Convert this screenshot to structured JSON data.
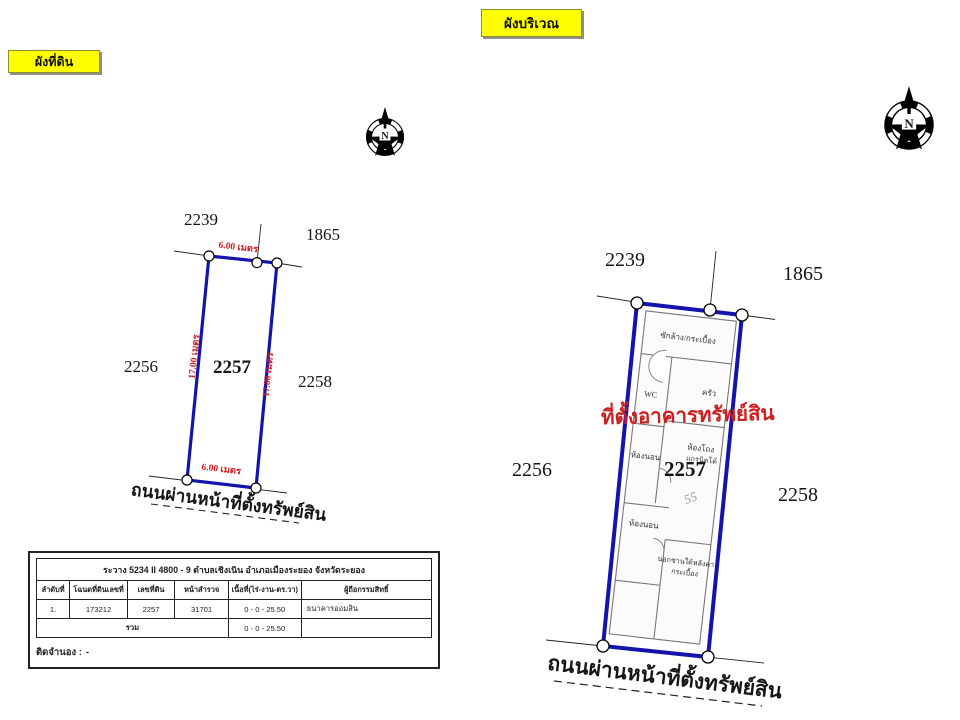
{
  "colors": {
    "boundary_blue": "#1414ad",
    "dimension_red": "#cc1f1f",
    "tag_yellow": "#ffff00",
    "wall_gray": "#777777"
  },
  "tags": {
    "land_plan": "ผังที่ดิน",
    "site_plan": "ผังบริเวณ"
  },
  "compass": {
    "letter": "N"
  },
  "land_plan": {
    "parcel_number": "2257",
    "neighbors": {
      "top_left": "2239",
      "top_right": "1865",
      "left": "2256",
      "right": "2258"
    },
    "dimensions": {
      "top": "6.00 เมตร",
      "bottom": "6.00 เมตร",
      "left": "17.00 เมตร",
      "right": "17.00 เมตร"
    },
    "road_label": "ถนนผ่านหน้าที่ตั้งทรัพย์สิน"
  },
  "site_plan": {
    "parcel_number": "2257",
    "neighbors": {
      "top_left": "2239",
      "top_right": "1865",
      "left": "2256",
      "right": "2258"
    },
    "building_label": "ที่ตั้งอาคารทรัพย์สิน",
    "handwritten_note": "55",
    "rooms": {
      "laundry": "ซักล้าง/กระเบื้อง",
      "wc": "WC",
      "kitchen": "ครัว",
      "bedroom_front": "ห้องนอน",
      "hall_line1": "ห้องโถง",
      "hall_line2": "แกรนิตโต้",
      "bedroom_back": "ห้องนอน",
      "terrace_line1": "นอกชานใต้หลังคา",
      "terrace_line2": "กระเบื้อง"
    },
    "road_label": "ถนนผ่านหน้าที่ตั้งทรัพย์สิน"
  },
  "survey_table": {
    "title": "ระวาง 5234 II 4800 - 9 ตำบลเชิงเนิน อำเภอเมืองระยอง จังหวัดระยอง",
    "columns": [
      "ลำดับที่",
      "โฉนดที่ดินเลขที่",
      "เลขที่ดิน",
      "หน้าสำรวจ",
      "เนื้อที่(ไร่-งาน-ตร.วา)",
      "ผู้ถือกรรมสิทธิ์"
    ],
    "rows": [
      {
        "no": "1.",
        "deed_no": "173212",
        "parcel_no": "2257",
        "survey_page": "31701",
        "area": "0 - 0 - 25.50",
        "owner": "ธนาคารออมสิน"
      }
    ],
    "total_label": "รวม",
    "total_area": "0 - 0 - 25.50",
    "mortgage_label": "ติดจำนอง :",
    "mortgage_value": "-"
  }
}
